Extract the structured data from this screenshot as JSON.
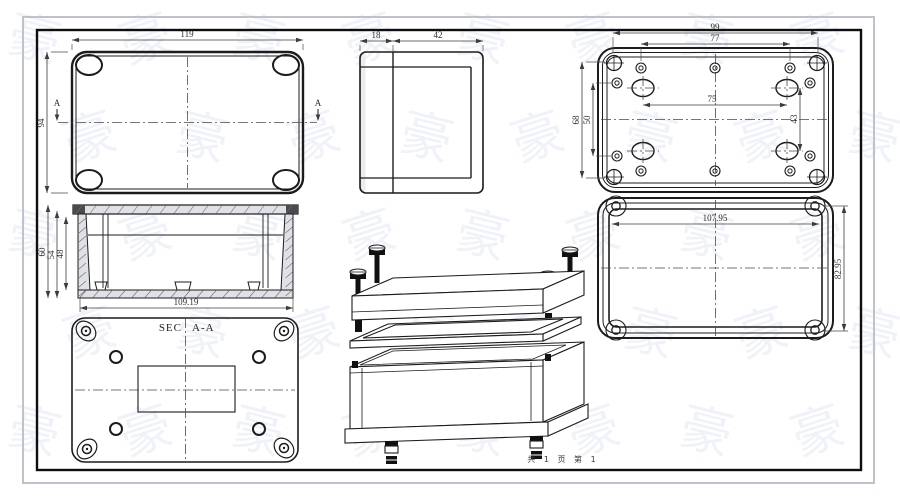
{
  "page": {
    "footer_text": "共 1 页  第 1",
    "watermark_glyph": "豪",
    "frame_outer_color": "#b8bcc6",
    "frame_inner_color": "#0e0e0e",
    "line_color": "#1c1c1c"
  },
  "views": {
    "top_view": {
      "section_label": "A",
      "dims": {
        "width": "119",
        "height": "94"
      }
    },
    "side_view": {
      "dims": {
        "lid_width": "18",
        "base_width": "42"
      }
    },
    "base_inside_view": {
      "dims": {
        "bolt_span_w": "99",
        "boss_span_w": "77",
        "hole_span_w": "75",
        "bolt_span_h": "68",
        "boss_span_h": "50",
        "hole_span_h": "43"
      }
    },
    "lid_inside_view": {
      "dims": {
        "width": "107.95",
        "height": "82.95"
      }
    },
    "section_view": {
      "label_left": "SEC",
      "label_right": "A-A",
      "dims": {
        "outer_depth": "60",
        "mid_depth": "54",
        "inner_depth": "48",
        "inner_width": "109.19"
      }
    }
  }
}
